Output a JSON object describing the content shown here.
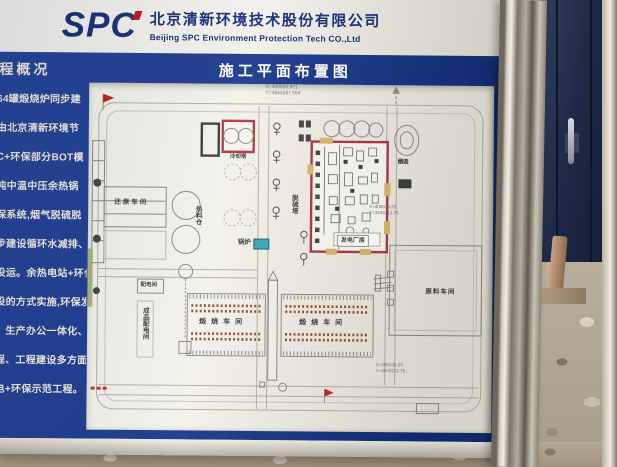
{
  "billboard": {
    "header": {
      "logo": "SPC",
      "company_cn": "北京清新环境技术股份有限公司",
      "company_en": "Beijing SPC Environment Protection Tech CO.,Ltd"
    },
    "overview": {
      "title": "程概况",
      "lines": [
        "64罐煅烧炉同步建",
        "由北京清新环境节",
        "C+环保部分BOT模",
        "吨中温中压余热锅",
        "保系统,烟气脱硫脱",
        "步建设循环水减排、脱",
        "投运。余热电站+环保",
        "设的方式实施,环保发",
        "、生产办公一体化、生产",
        "程、工程建设多方面树立",
        "电+环保示范工程。"
      ]
    },
    "plan": {
      "title": "施工平面布置图",
      "coords": {
        "top1": "X=408900.971",
        "top2": "Y=3943287.564",
        "right1": "X=408836.29",
        "right2": "Y=3943212.75",
        "bottom1": "X=408136.29",
        "bottom2": "Y=3943212.75"
      },
      "labels": {
        "cooling_tower": "冷却塔",
        "power_house": "发电厂房",
        "boiler": "锅炉",
        "desulfurization_tower": "脱硫塔",
        "hot_material_silo": "热料仓",
        "reduction_workshop": "还原车间",
        "power_distribution_room": "配电间",
        "product_power_room": "成品配电间",
        "calcining_workshop_left": "煅烧车间",
        "calcining_workshop_right": "煅烧车间",
        "chimney": "烟囱",
        "raw_material_workshop": "原料车间"
      }
    }
  },
  "colors": {
    "board_blue": "#1c3b92",
    "header_navy": "#16327f",
    "highlight_red": "#b23a46",
    "boiler_teal": "#37a6b4"
  }
}
